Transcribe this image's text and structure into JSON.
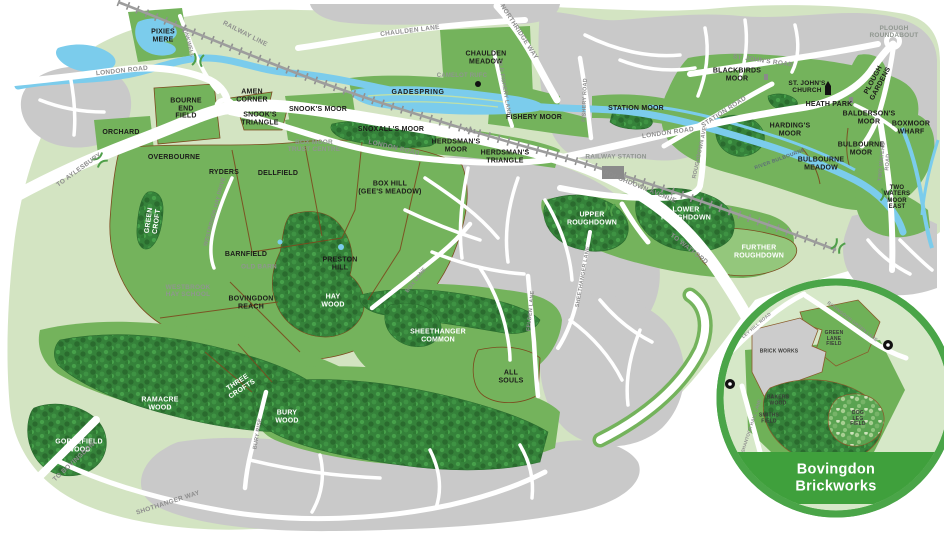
{
  "labels": {
    "pixies_mere": "PIXIES\nMERE",
    "chaulden_meadow": "CHAULDEN\nMEADOW",
    "amen_corner": "AMEN\nCORNER",
    "bourne_end_field": "BOURNE\nEND\nFIELD",
    "snooks_triangle": "SNOOK'S\nTRIANGLE",
    "snooks_moor": "SNOOK'S MOOR",
    "orchard": "ORCHARD",
    "overbourne": "OVERBOURNE",
    "snoxalls_moor": "SNOXALL'S MOOR",
    "herdsmans_moor": "HERDSMAN'S\nMOOR",
    "herdsmans_triangle": "HERDSMAN'S\nTRIANGLE",
    "gadespring": "GADESPRING",
    "fishery_moor": "FISHERY MOOR",
    "station_moor": "STATION MOOR",
    "blackbirds_moor": "BLACKBIRDS\nMOOR",
    "st_johns_church": "ST. JOHN'S\nCHURCH",
    "heath_park": "HEATH PARK",
    "baldersons_moor": "BALDERSON'S\nMOOR",
    "hardings_moor": "HARDING'S\nMOOR",
    "bulbourne_moor": "BULBOURNE\nMOOR",
    "bulbourne_meadow": "BULBOURNE\nMEADOW",
    "boxmoor_wharf": "BOXMOOR\nWHARF",
    "two_waters_moor_east": "TWO\nWATERS\nMOOR\nEAST",
    "plough_roundabout": "PLOUGH\nROUNDABOUT",
    "plough_gardens": "PLOUGH\nGARDENS",
    "ryders": "RYDERS",
    "dellfield": "DELLFIELD",
    "box_hill": "BOX HILL\n(GEE'S MEADOW)",
    "green_croft": "GREEN\nCROFT",
    "barnfield": "BARNFIELD",
    "old_barn": "OLD BARN",
    "westbrook_hay_school": "WESTBROOK\nHAY SCHOOL",
    "preston_hill": "PRESTON\nHILL",
    "bovingdon_reach": "BOVINGDON\nREACH",
    "hay_wood": "HAY\nWOOD",
    "upper_roughdown": "UPPER\nROUGHDOWN",
    "lower_roughdown": "LOWER\nROUGHDOWN",
    "further_roughdown": "FURTHER\nROUGHDOWN",
    "sheethanger_common": "SHEETHANGER\nCOMMON",
    "all_souls": "ALL\nSOULS",
    "three_crofts": "THREE\nCROFTS",
    "ramacre_wood": "RAMACRE\nWOOD",
    "bury_wood": "BURY\nWOOD",
    "gorsefield_wood": "GORSEFIELD\nWOOD",
    "box_moor_trust_centre": "BOX MOOR\nTRUST CENTRE",
    "railway_station": "RAILWAY STATION",
    "camelot_rufc": "CAMELOT RUFC"
  },
  "roads": {
    "london_road_west": "LONDON ROAD",
    "london_road_mid": "LONDON ROAD",
    "london_road_east": "LONDON ROAD",
    "chaulden_lane": "CHAULDEN LANE",
    "northridge_way": "NORTHRIDGE WAY",
    "railway_line": "RAILWAY LINE",
    "winkwell": "WINKWELL",
    "old_fishery_lane": "OLD FISHERY LANE",
    "fishery_road": "FISHERY ROAD",
    "st_johns_road": "ST. JOHN'S ROAD",
    "station_road": "STATION ROAD",
    "a41": "A41",
    "roughdown_avenue": "ROUGHDOWN AVENUE",
    "roughdown_ave_vertical": "ROUGHDOWN AVE",
    "to_watford": "TO WATFORD",
    "to_aylesbury": "TO AYLESBURY",
    "to_bovingdon": "TO BOVINGDON",
    "shothanger_way": "SHOTHANGER WAY",
    "sheethanger_lane": "SHEETHANGER LANE",
    "felden_lane": "FELDEN LANE",
    "box_lane": "BOX LANE",
    "westbrook_hay_drive": "WESTBROOK HAY DRIVE",
    "bury_rise": "BURY RISE",
    "two_waters_road": "TWO WATERS ROAD"
  },
  "water": {
    "river_bulbourne": "RIVER BULBOURNE"
  },
  "inset": {
    "title": "Bovingdon\nBrickworks",
    "brick_works": "BRICK WORKS",
    "green_lane_field": "GREEN\nLANE\nFIELD",
    "bakers_wood": "BAKERS\nWOOD",
    "smiths_field": "SMITHS\nFIELD",
    "dog_leg_field": "DOG\nLEG\nFIELD",
    "ley_hill_road": "LEY HILL ROAD",
    "bovingdon_green_lane": "BOVINGDON GREEN LANE",
    "shantock_hall_lane": "SHANTOCK HALL LANE"
  },
  "icons": {
    "church-icon": "black church symbol",
    "building-icon": "small gray building block",
    "sports-club-marker-icon": "black dot (Camelot RUFC)",
    "railway-station-icon": "gray station block",
    "access-point-icon": "black circular access marker",
    "bridge-icon": "green double chevron bridge mark",
    "roundabout-icon": "white road ring"
  },
  "colors": {
    "land": "#d3e4c2",
    "urban": "#c9c9c9",
    "moor_green": "#74b35c",
    "light_moor_green": "#94c77c",
    "wood_green": "#35823a",
    "water_blue": "#7bccec",
    "railway_gray": "#8f8f8f",
    "field_boundary_brown": "#7c4a1e",
    "label_black": "#1c1c1a",
    "road_label_gray": "#8d8d8d",
    "inset_ring_green": "#4aa548",
    "inset_band_green": "#3fa03c"
  }
}
